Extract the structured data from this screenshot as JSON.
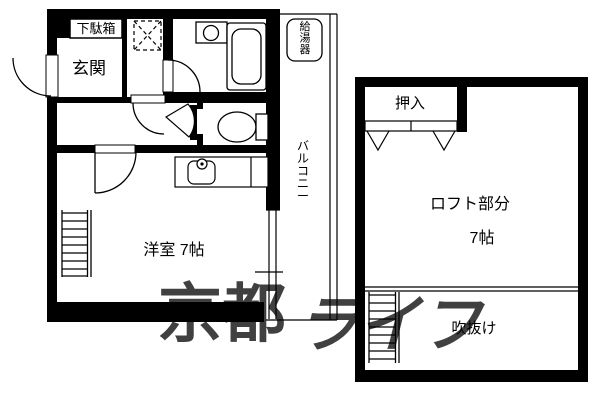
{
  "plan_type": "floor-plan",
  "floor1": {
    "shoe_cabinet": "下駄箱",
    "entrance": "玄関",
    "water_heater": "給湯器",
    "balcony": "バルコニー",
    "main_room": "洋室 7帖"
  },
  "loft": {
    "closet": "押入",
    "loft_area": "ロフト部分",
    "loft_size": "7帖",
    "void": "吹抜け"
  },
  "watermark": {
    "part1": "京都",
    "part2": "ライフ"
  },
  "colors": {
    "wall": "#000000",
    "background": "#ffffff",
    "watermark": "#dcdcdc"
  }
}
